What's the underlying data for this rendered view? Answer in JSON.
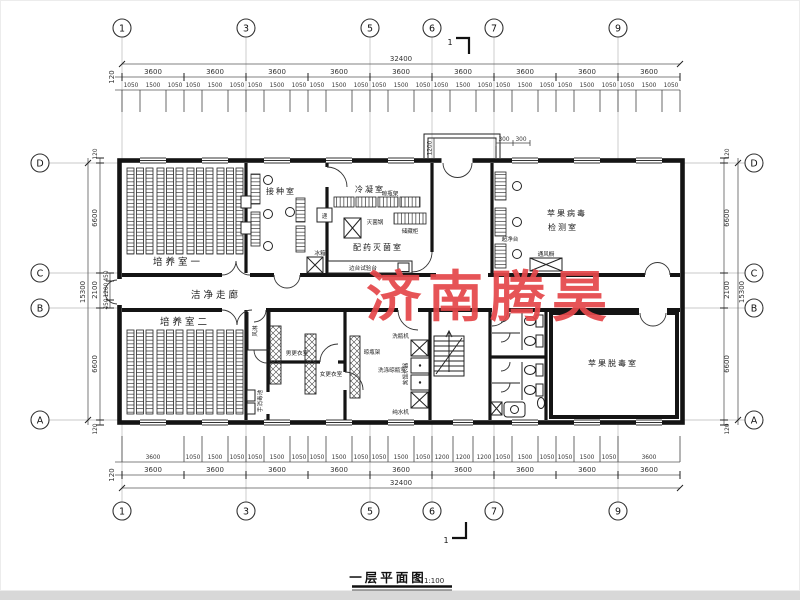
{
  "watermark": "济南腾昊",
  "titleblock": {
    "title": "一层平面图",
    "scale": "1:100"
  },
  "section": {
    "label": "1"
  },
  "grid": {
    "top": [
      "1",
      "3",
      "5",
      "6",
      "7",
      "9"
    ],
    "left": [
      "D",
      "C",
      "B",
      "A"
    ]
  },
  "dims": {
    "overall_w": "32400",
    "overall_h": "15300",
    "edge": "120",
    "bay": "3600",
    "top_sub": [
      "1050",
      "1500",
      "1050",
      "1050",
      "1500",
      "1050",
      "1050",
      "1500",
      "1050",
      "1050",
      "1500",
      "1050",
      "1050",
      "1500",
      "1050",
      "1050",
      "1500",
      "1050",
      "1050",
      "1500",
      "1050",
      "1050",
      "1500",
      "1050",
      "1050",
      "1500",
      "1050"
    ],
    "bottom_sub": [
      "3600",
      "1050",
      "1500",
      "1050",
      "1050",
      "1500",
      "1050",
      "1050",
      "1500",
      "1050",
      "1050",
      "1500",
      "1050",
      "1200",
      "1200",
      "1200",
      "1050",
      "1500",
      "1050",
      "1050",
      "1500",
      "1050",
      "3600"
    ],
    "left_main": [
      "120",
      "6600",
      "2100",
      "6600",
      "120"
    ],
    "left_sub": [
      "450",
      "1200",
      "450"
    ],
    "porch": {
      "depth": "1200",
      "step1": "300",
      "step2": "300"
    }
  },
  "rooms": {
    "culture1": "培养室一",
    "inoculation": "接种室",
    "condensing": "冷凝室",
    "dispensing": "配药灭菌室",
    "detection1": "苹果病毒",
    "detection2": "检测室",
    "corridor": "洁净走廊",
    "culture2": "培养室二",
    "air_shower": "风淋",
    "male_locker": "男更衣室",
    "female_locker": "女更衣室",
    "washing": "洗涤晾瓶室",
    "detox": "苹果脱毒室"
  },
  "equipment": {
    "pass_box": "递",
    "sterilizer": "灭菌锅",
    "bottle_rack": "晾瓶架",
    "storage_cabinet": "储藏柜",
    "fridge": "冰箱",
    "side_bench": "边台试验台",
    "clean_bench": "超净台",
    "fume_hood": "通风橱",
    "bottle_washer": "洗瓶机",
    "distiller": "蒸馏水器",
    "water_purifier": "纯水机",
    "hand_sink": "手消毒池"
  }
}
